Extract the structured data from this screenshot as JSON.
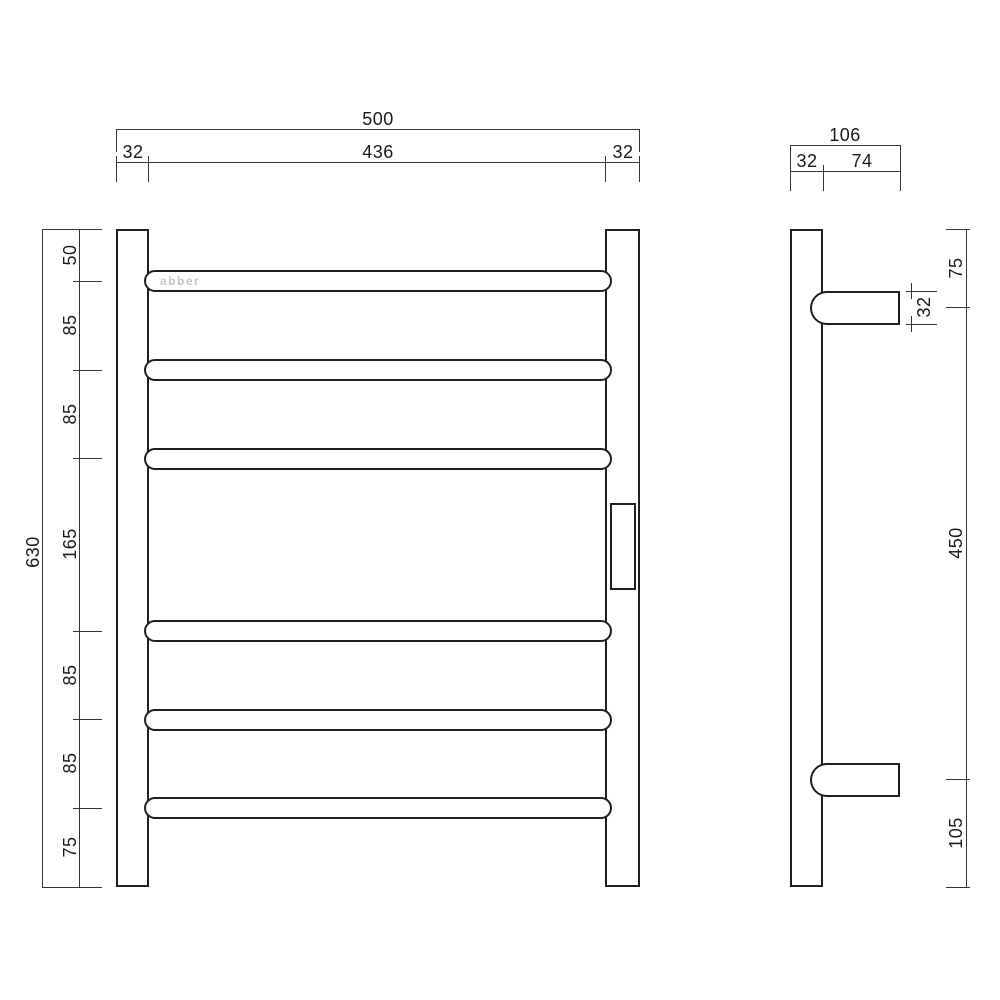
{
  "drawing": {
    "brand_logo": "abber",
    "front_view": {
      "top_dims": {
        "overall_width": "500",
        "left_offset": "32",
        "inner_width": "436",
        "right_offset": "32"
      },
      "left_dims": {
        "overall_height": "630",
        "chain": [
          "50",
          "85",
          "85",
          "165",
          "85",
          "85",
          "75"
        ]
      }
    },
    "side_view": {
      "top_dims": {
        "overall_depth": "106",
        "rail_depth": "32",
        "bracket_length": "74"
      },
      "right_dims": {
        "chain": [
          "75",
          "450",
          "105"
        ],
        "tube_diameter": "32"
      }
    }
  }
}
